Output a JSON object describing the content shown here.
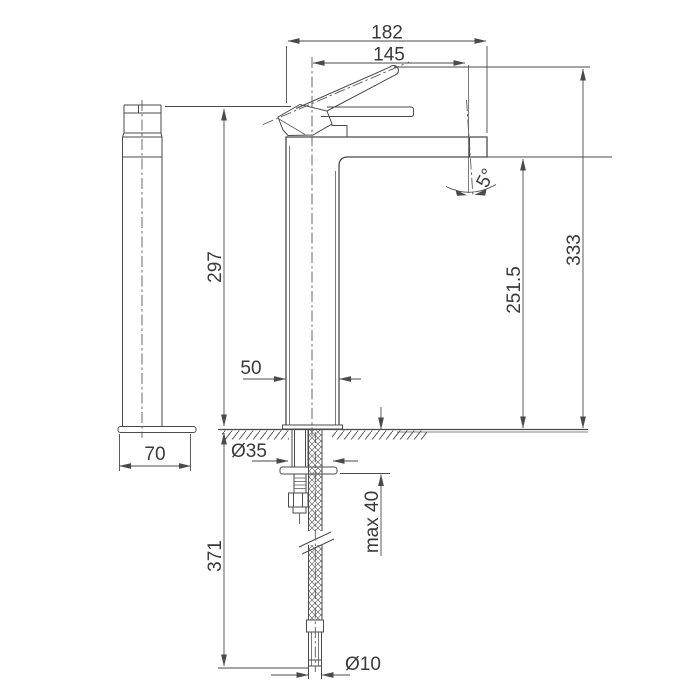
{
  "drawing": {
    "subject": "tall-single-lever-basin-faucet-technical-drawing",
    "views": [
      "side-view",
      "front-section-view"
    ]
  },
  "dimensions": {
    "overall_width": "182",
    "spout_projection": "145",
    "spout_angle": "5°",
    "overall_height": "333",
    "body_height": "297",
    "spout_outlet_height": "251.5",
    "body_width": "50",
    "base_width": "70",
    "mounting_hole_diameter": "Ø35",
    "max_counter_thickness": "max 40",
    "below_counter_length": "371",
    "hose_tail_diameter": "Ø10"
  },
  "colors": {
    "line": "#4a4a4a",
    "text": "#3a3a3a",
    "background": "#ffffff"
  }
}
